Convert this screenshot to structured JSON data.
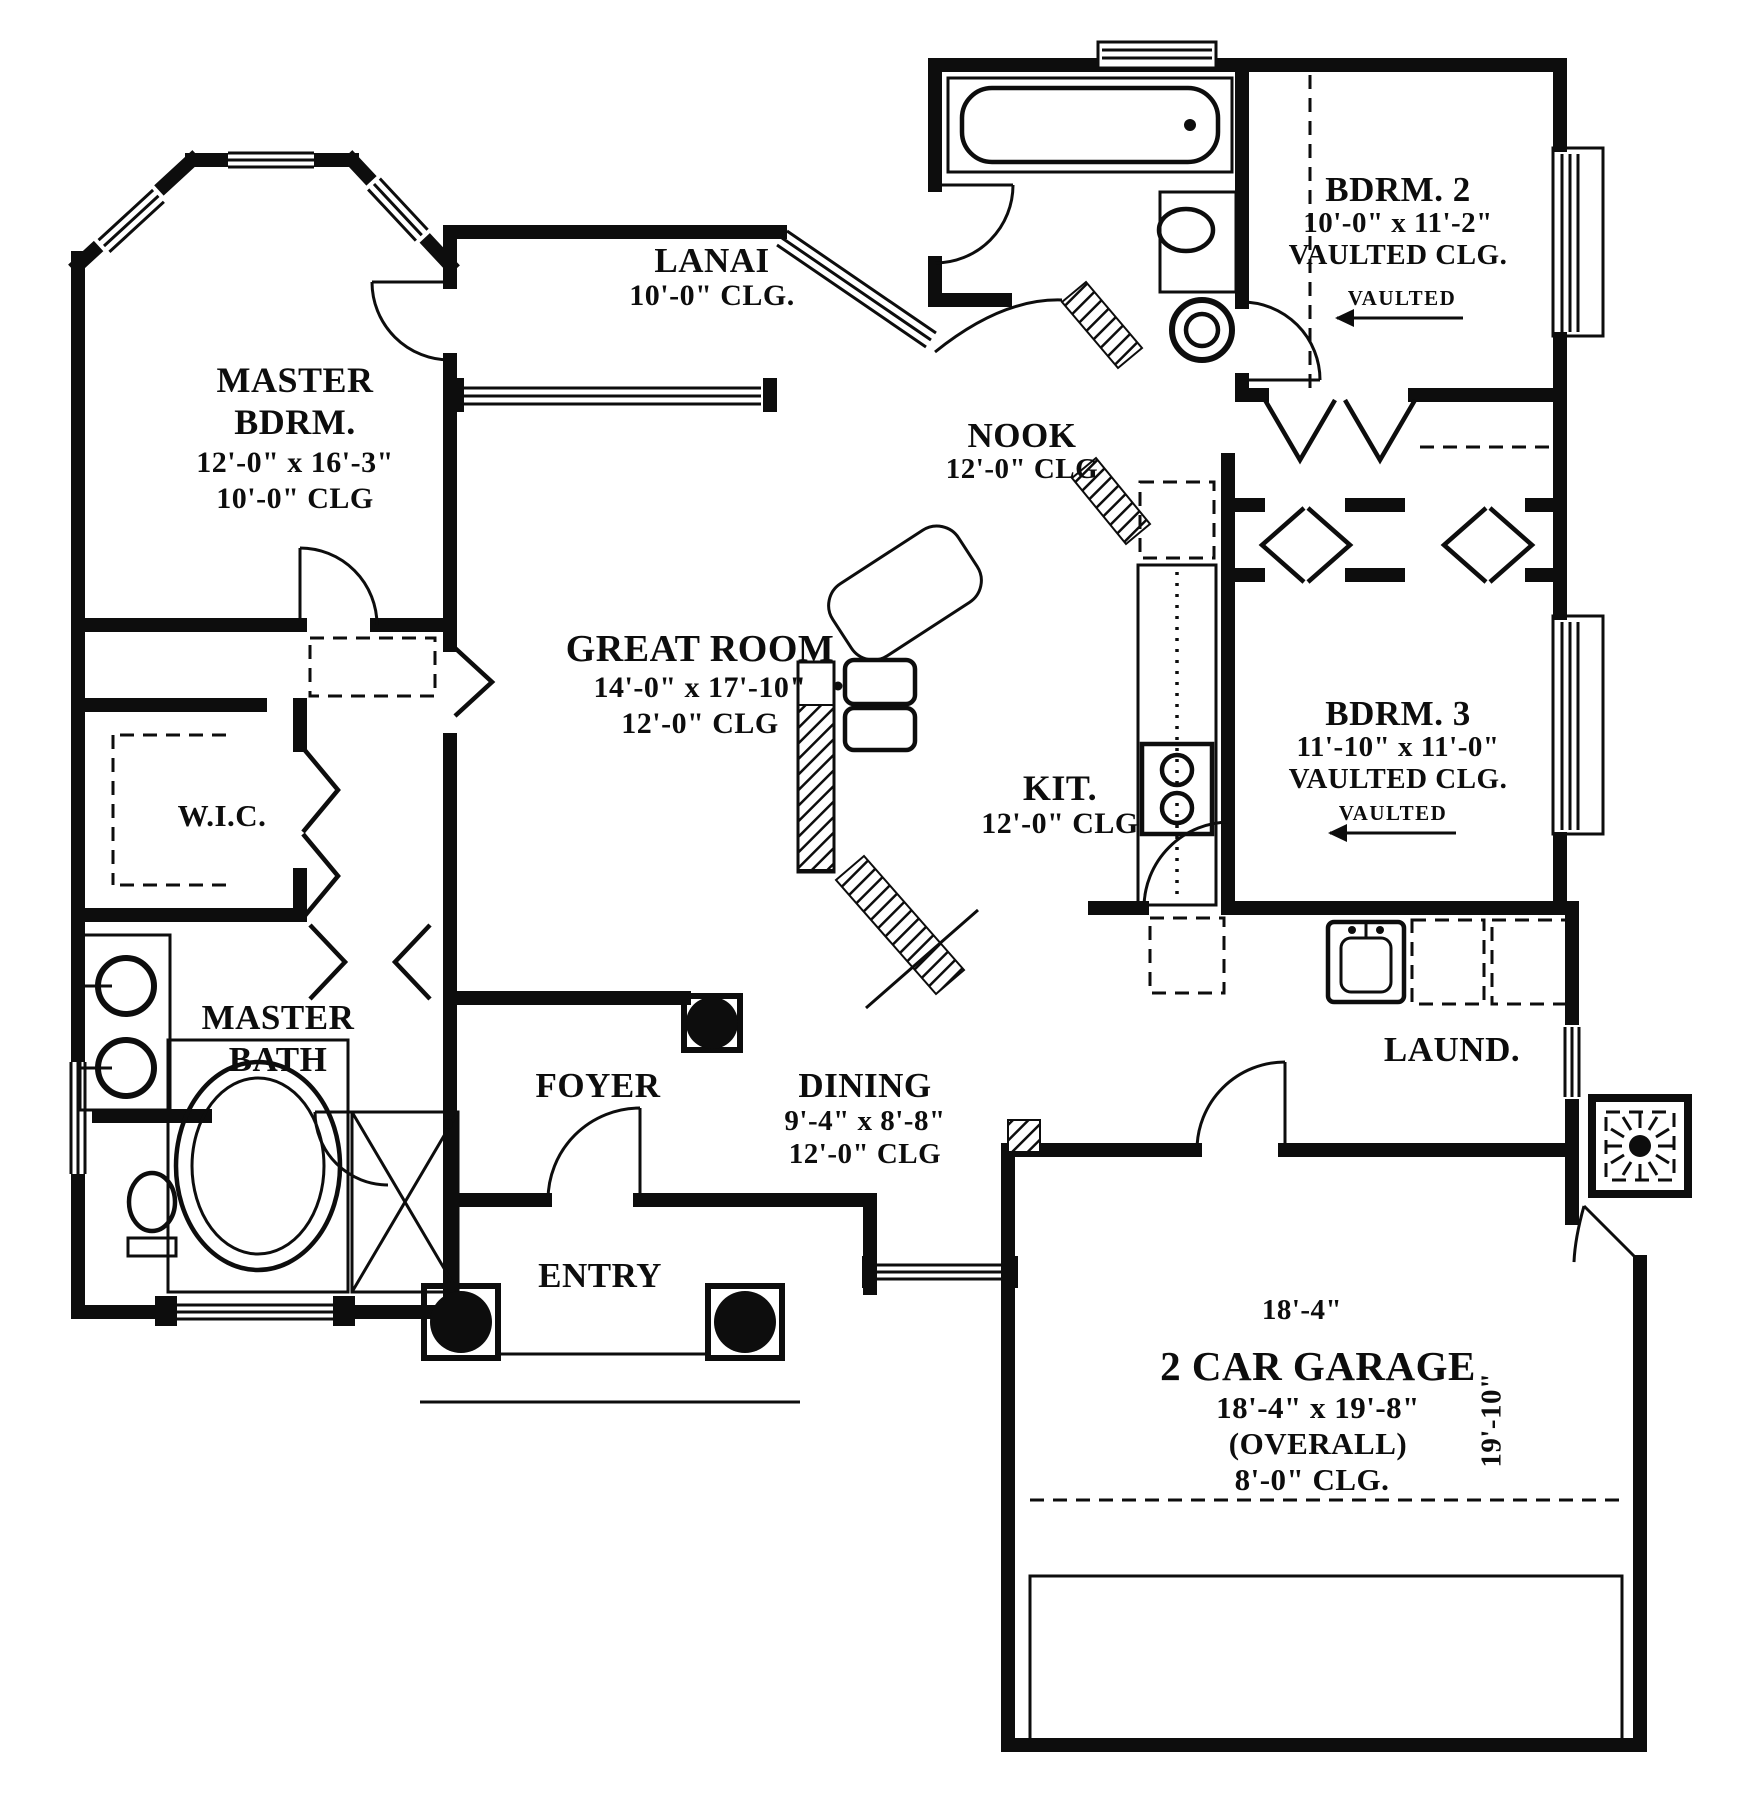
{
  "rooms": {
    "master_bedroom": {
      "label_line1": "MASTER",
      "label_line2": "BDRM.",
      "dimensions": "12'-0\" x 16'-3\"",
      "ceiling": "10'-0\" CLG"
    },
    "lanai": {
      "label": "LANAI",
      "ceiling": "10'-0\" CLG."
    },
    "bedroom2": {
      "label": "BDRM. 2",
      "dimensions": "10'-0\" x 11'-2\"",
      "ceiling": "VAULTED CLG.",
      "vaulted_tag": "VAULTED"
    },
    "nook": {
      "label": "NOOK",
      "ceiling": "12'-0\" CLG"
    },
    "great_room": {
      "label": "GREAT ROOM",
      "dimensions": "14'-0\" x 17'-10\"",
      "ceiling": "12'-0\" CLG"
    },
    "kitchen": {
      "label": "KIT.",
      "ceiling": "12'-0\" CLG"
    },
    "bedroom3": {
      "label": "BDRM. 3",
      "dimensions": "11'-10\" x 11'-0\"",
      "ceiling": "VAULTED CLG.",
      "vaulted_tag": "VAULTED"
    },
    "walk_in_closet": {
      "label": "W.I.C."
    },
    "master_bath": {
      "label_line1": "MASTER",
      "label_line2": "BATH"
    },
    "foyer": {
      "label": "FOYER"
    },
    "entry": {
      "label": "ENTRY"
    },
    "dining": {
      "label": "DINING",
      "dimensions": "9'-4\" x 8'-8\"",
      "ceiling": "12'-0\" CLG"
    },
    "laundry": {
      "label": "LAUND."
    },
    "garage": {
      "label": "2 CAR GARAGE",
      "width_dimension": "18'-4\"",
      "dimensions": "18'-4\" x 19'-8\"",
      "overall": "(OVERALL)",
      "ceiling": "8'-0\" CLG.",
      "depth_dimension": "19'-10\""
    }
  },
  "colors": {
    "ink": "#0d0d0d",
    "background": "#ffffff"
  }
}
